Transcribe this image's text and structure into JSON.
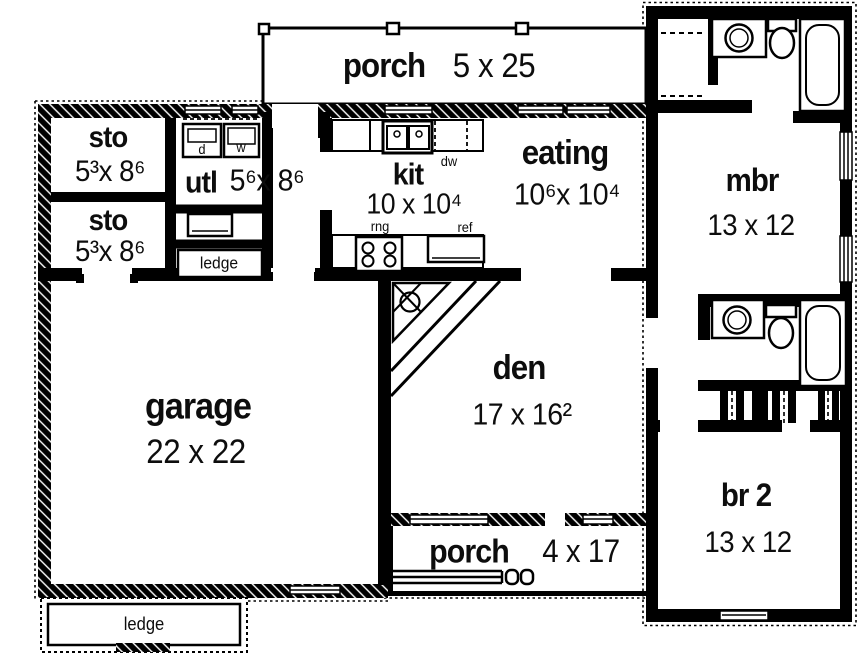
{
  "plan_title": "single-story house floor plan",
  "colors": {
    "wall": "#000000",
    "floor": "#ffffff",
    "background": "#ffffff",
    "text": "#0d0d0d"
  },
  "rooms": {
    "porch_top": {
      "label": "porch",
      "dims": "5 x 25"
    },
    "sto_1": {
      "label": "sto",
      "dims": "5³x 8⁶"
    },
    "sto_2": {
      "label": "sto",
      "dims": "5³x 8⁶"
    },
    "utl": {
      "label": "utl",
      "dims": "5⁶x 8⁶"
    },
    "kit": {
      "label": "kit",
      "dims": "10 x 10⁴"
    },
    "eating": {
      "label": "eating",
      "dims": "10⁶x 10⁴"
    },
    "mbr": {
      "label": "mbr",
      "dims": "13 x 12"
    },
    "garage": {
      "label": "garage",
      "dims": "22 x 22"
    },
    "den": {
      "label": "den",
      "dims": "17 x 16²"
    },
    "br_2": {
      "label": "br 2",
      "dims": "13 x 12"
    },
    "porch_bottom": {
      "label": "porch",
      "dims": "4 x 17"
    }
  },
  "labels": {
    "dryer": "d",
    "washer": "w",
    "dishwasher": "dw",
    "range": "rng",
    "refrigerator": "ref",
    "ledge_utility": "ledge",
    "ledge_garage": "ledge"
  }
}
